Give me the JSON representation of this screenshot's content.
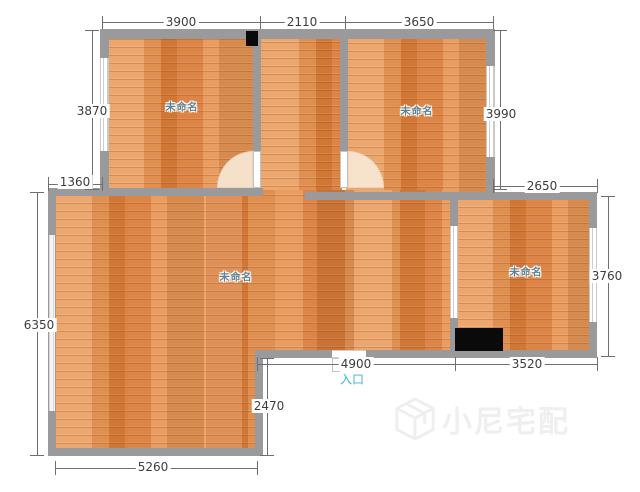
{
  "plan": {
    "rooms": [
      {
        "label": "未命名"
      },
      {
        "label": "未命名"
      },
      {
        "label": "未命名"
      },
      {
        "label": "未命名"
      }
    ],
    "entrance_label": "入口",
    "dimensions": {
      "top": [
        "3900",
        "2110",
        "3650"
      ],
      "left_upper": "3870",
      "left_step": "1360",
      "left_lower": "6350",
      "right_upper": "3990",
      "right_step": "2650",
      "right_lower": "3760",
      "bottom_left": "5260",
      "bottom_notch": "2470",
      "bottom_middle": "4900",
      "bottom_right": "3520"
    },
    "watermark": "小尼宅配",
    "colors": {
      "floor": "#e2823c",
      "wall": "#9a9a9c",
      "dimension_text": "#3d3d3d",
      "room_label_text": "#64808f",
      "entrance_text": "#3fb0da"
    }
  }
}
